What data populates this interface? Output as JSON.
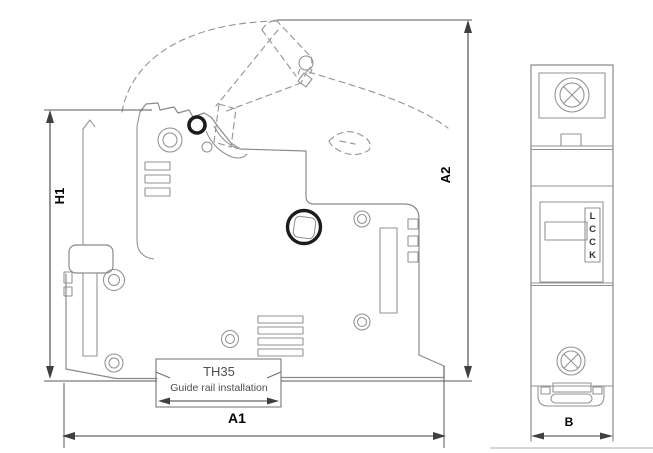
{
  "drawing": {
    "side_view": {
      "rail": {
        "model": "TH35",
        "caption": "Guide rail installation"
      },
      "dims": {
        "height_closed": "H1",
        "height_open": "A2",
        "depth": "A1"
      }
    },
    "front_view": {
      "brand_letters": [
        "L",
        "C",
        "C",
        "K"
      ],
      "dims": {
        "width": "B"
      }
    },
    "colors": {
      "drawing_line": "#8a8a8a",
      "dark_feature": "#1c1c1c",
      "dimension_line": "#3f3f3f",
      "label_text": "#000000"
    }
  }
}
